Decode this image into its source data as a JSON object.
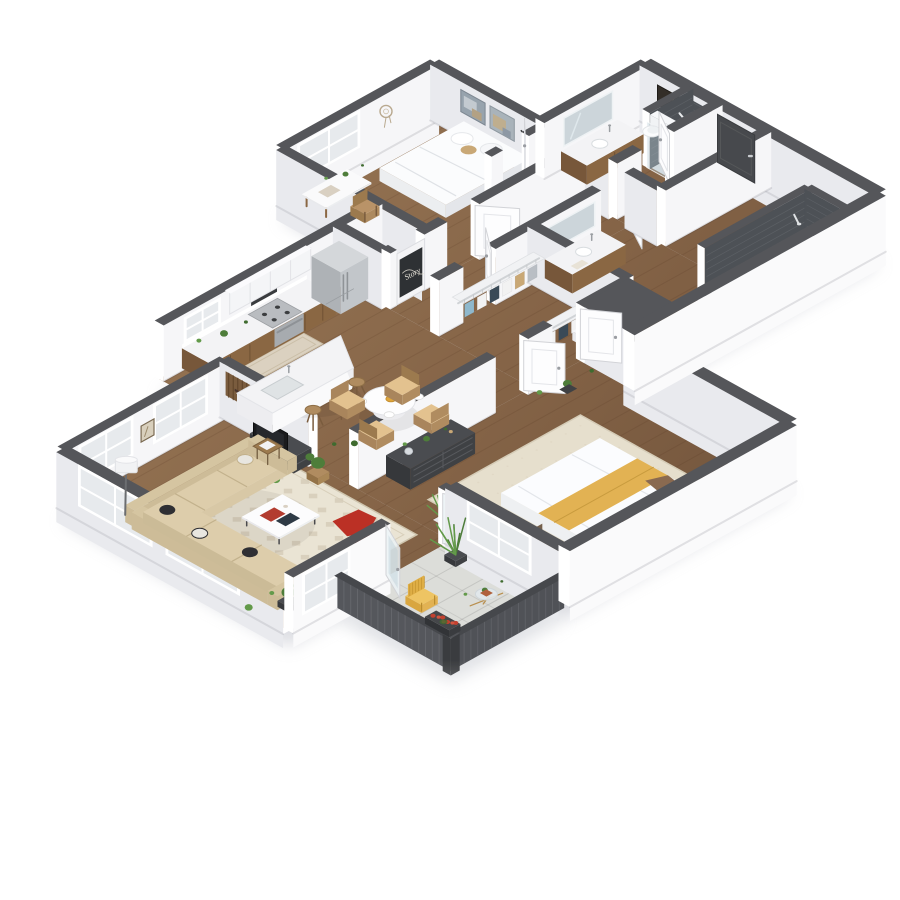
{
  "scene": {
    "type": "isometric-3d-apartment-floor-plan",
    "chalkboard_text": "Story",
    "rooms": [
      {
        "name": "living-room",
        "items": [
          "sectional-sofa",
          "patterned-area-rug",
          "coffee-table",
          "side-table",
          "arc-floor-lamp",
          "tv-console",
          "tv",
          "wood-slat-wall-art",
          "framed-art",
          "potted-plants",
          "pouf-with-red-throw",
          "corner-windows"
        ]
      },
      {
        "name": "kitchen",
        "items": [
          "white-upper-cabinets",
          "wood-base-cabinets",
          "microwave",
          "range",
          "refrigerator",
          "window",
          "island-with-sink",
          "bar-stools",
          "runner-rug",
          "counter-plant"
        ]
      },
      {
        "name": "dining-area",
        "items": [
          "round-table-with-place-settings",
          "four-woven-chairs",
          "floor-plant"
        ]
      },
      {
        "name": "pantry",
        "items": [
          "chalkboard-door"
        ]
      },
      {
        "name": "bedroom-2",
        "items": [
          "bed-with-white-bedding",
          "two-abstract-canvases",
          "desk",
          "desk-chair",
          "window",
          "dream-catcher",
          "reach-in-closet-with-wire-shelf"
        ]
      },
      {
        "name": "bathroom-2",
        "items": [
          "wood-vanity",
          "mirror",
          "toilet",
          "dark-tile-shower-with-glass",
          "framed-art"
        ]
      },
      {
        "name": "hallway",
        "items": [
          "open-white-doors"
        ]
      },
      {
        "name": "entry",
        "items": [
          "charcoal-entry-door"
        ]
      },
      {
        "name": "walk-in-closet",
        "items": [
          "wire-shelving",
          "hanging-clothes",
          "shoe-shelf"
        ]
      },
      {
        "name": "master-bathroom",
        "items": [
          "wood-vanity",
          "mirror",
          "toilet",
          "bathtub",
          "dark-subway-tile-surround",
          "shower-head"
        ]
      },
      {
        "name": "master-bedroom",
        "items": [
          "bed-with-mustard-runner",
          "charcoal-dresser",
          "globe-decor",
          "nightstand",
          "brown-armchair",
          "beige-area-rug",
          "window",
          "floor-plant"
        ]
      },
      {
        "name": "balcony",
        "items": [
          "charcoal-slat-railing",
          "yellow-wire-chair",
          "round-glass-table",
          "tall-plant",
          "flower-box-red-blooms",
          "concrete-floor"
        ]
      }
    ]
  },
  "palette": {
    "wallCap": "#55565a",
    "faceSE": "#f6f6f8",
    "faceSW": "#e9eaee",
    "faceExt": "#fafafb",
    "woodLight": "#9b7a58",
    "woodDark": "#6f523a",
    "plankLine": "rgba(80,50,28,0.16)",
    "balconyFloor": "#dcddd9",
    "rugLiving": "#eae4d4",
    "rugPattern": "#d6cdb9",
    "rugMaster": "#e6dfcd",
    "runner": "#dbd1c0",
    "sofa": "#d8c8a6",
    "sofaBack": "#cdbc98",
    "white": "#fcfcfd",
    "darkFurniture": "#3f4144",
    "tv": "#1a1b1d",
    "woodCabinet": "#8a6743",
    "woodCabinetDark": "#77573a",
    "counter": "#f3f3f5",
    "steel": "#c2c6ca",
    "steelDark": "#aeb2b6",
    "tileDark": "#4d5156",
    "tileLine": "#5c6065",
    "glass": "#e7eaed",
    "glassBlue": "rgba(185,205,215,0.42)",
    "accentRed": "#bb3025",
    "accentYellow": "#e2b253",
    "plant": "#4e7d3a",
    "plantLight": "#639a4a",
    "plantDark": "#3f6b2f",
    "basket": "#a98757",
    "chairWood": "#b08c60",
    "chairSeat": "#e3c28f",
    "clothesBlue": "#8fb8cc",
    "clothesTan": "#c9a876",
    "clothesNavy": "#3a4a57",
    "wire": "#d0d3d6",
    "doorWhite": "#fdfdfe",
    "doorEdge": "#d2d3d7",
    "doorDark": "#47494d",
    "mirror": "#ccd5da"
  }
}
